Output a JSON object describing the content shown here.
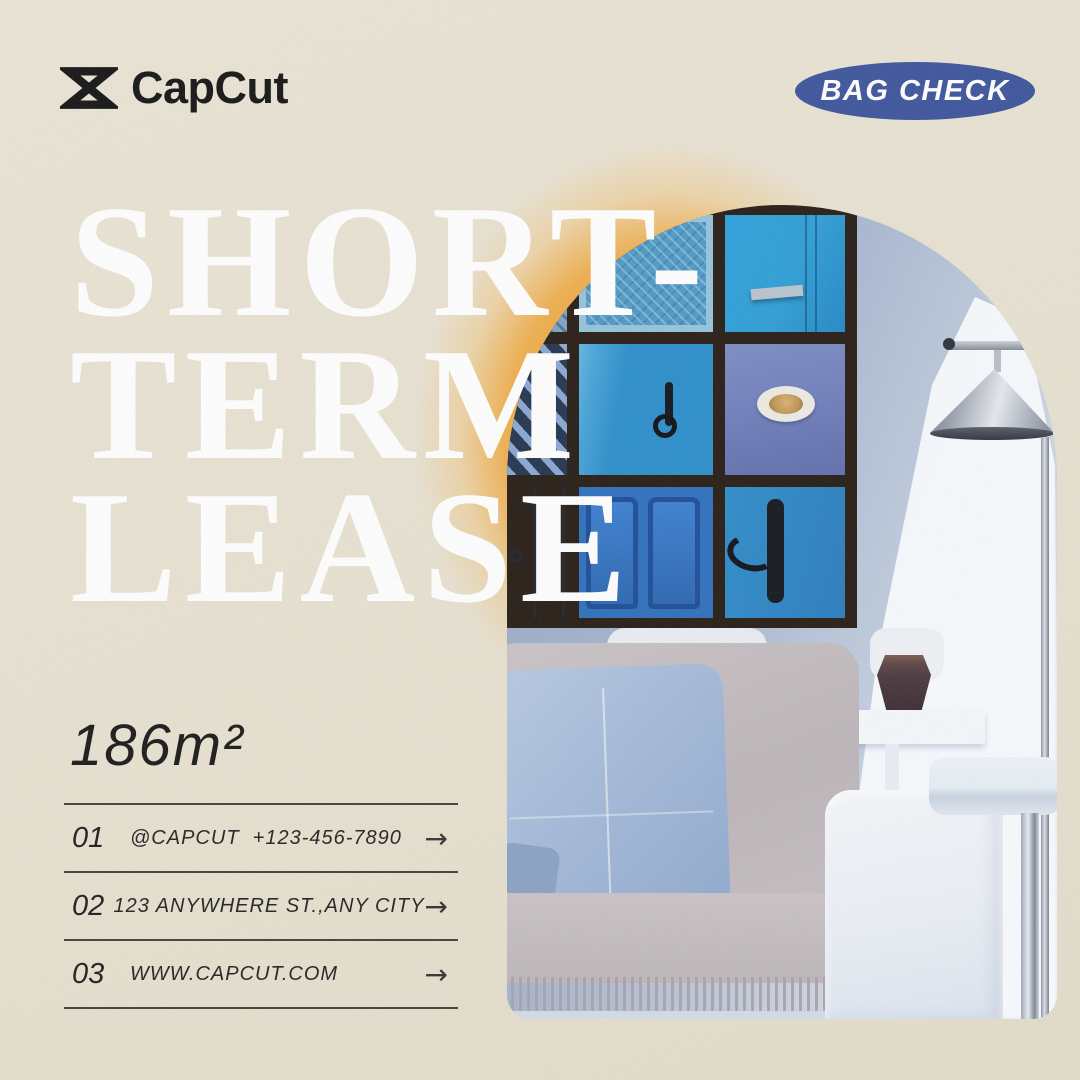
{
  "brand": {
    "name": "CapCut",
    "icon": "capcut-logo-icon"
  },
  "badge": {
    "label": "BAG CHECK",
    "bg_color": "#3c549c",
    "text_color": "#ffffff"
  },
  "headline": {
    "line1": "SHORT-",
    "line2": "TERM",
    "line3": "LEASE",
    "color": "#ffffff"
  },
  "listing": {
    "area": "186m²"
  },
  "contacts": {
    "arrow_icon": "→",
    "rows": [
      {
        "num": "01",
        "text": "@CAPCUT  +123-456-7890"
      },
      {
        "num": "02",
        "text": "123 ANYWHERE ST.,ANY CITY"
      },
      {
        "num": "03",
        "text": "WWW.CAPCUT.COM"
      }
    ]
  },
  "colors": {
    "background": "#e7e1d0",
    "glow_orange": "#f0a12b",
    "badge_blue": "#3c549c",
    "text_dark": "#1c1c1c",
    "headline_white": "#ffffff"
  }
}
